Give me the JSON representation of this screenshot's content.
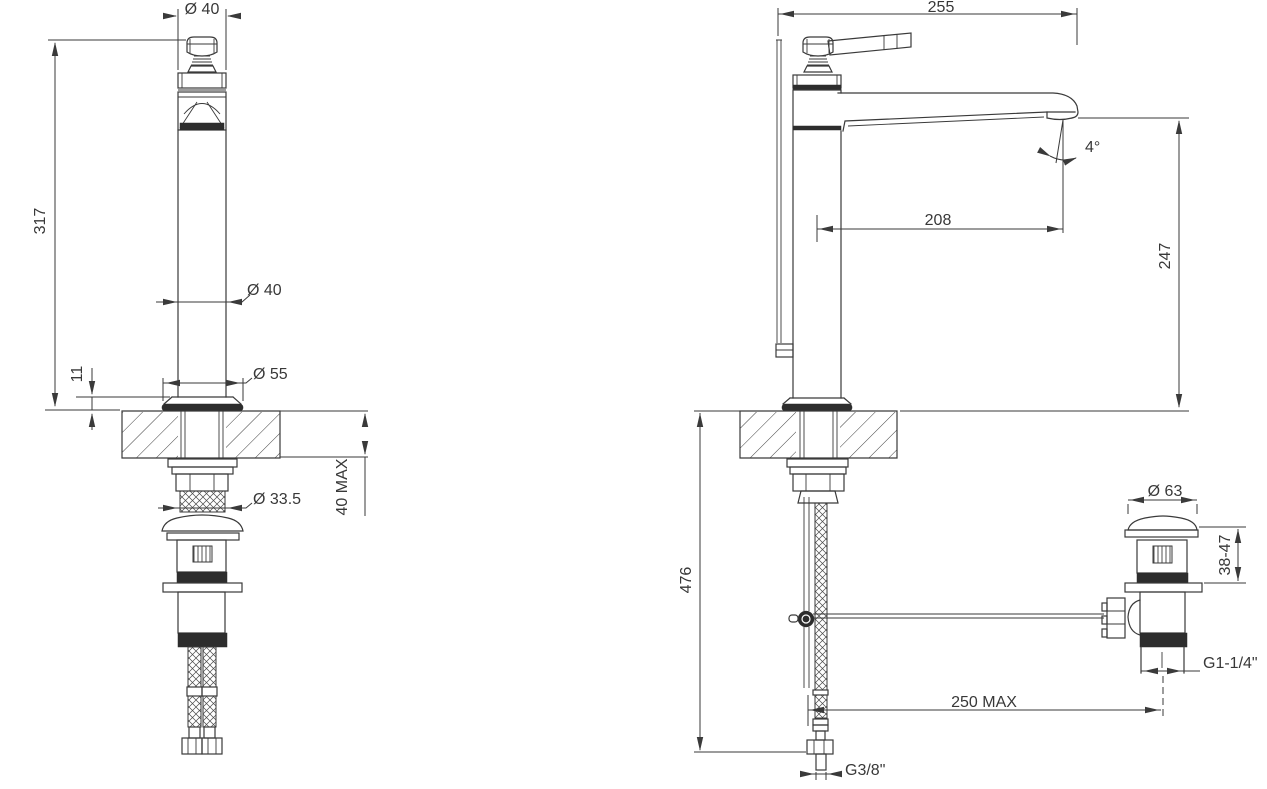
{
  "drawing_type": "faucet installation technical drawing, front and side views with pop-up waste",
  "colors": {
    "background": "#ffffff",
    "line": "#3a3a3a",
    "dark_fill": "#2d2d2d"
  },
  "dims": {
    "handle_dia": "Ø 40",
    "height_above_deck": "317",
    "body_dia": "Ø 40",
    "base_height": "11",
    "base_dia": "Ø 55",
    "deck_thickness_max": "40 MAX",
    "shank_dia": "Ø 33.5",
    "overall_depth": "255",
    "spout_angle": "4°",
    "spout_reach": "208",
    "spout_height": "247",
    "overall_height": "476",
    "waste_cap_dia": "Ø 63",
    "waste_adjust_range": "38-47",
    "waste_thread": "G1-1/4\"",
    "linkage_reach_max": "250 MAX",
    "supply_hose_thread": "G3/8\""
  }
}
